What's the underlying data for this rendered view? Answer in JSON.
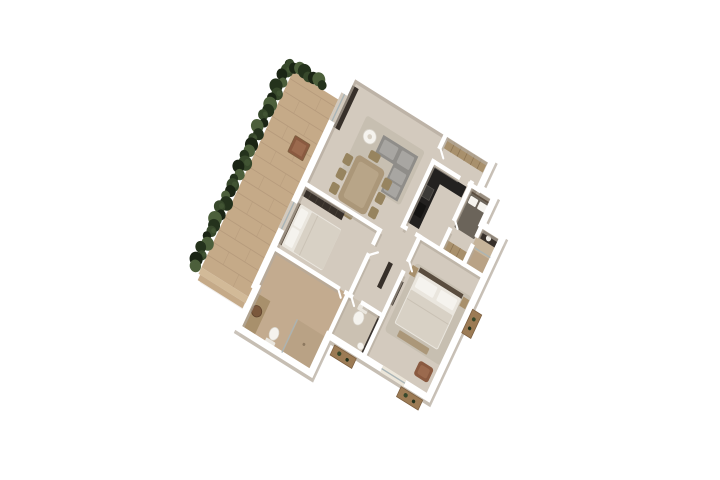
{
  "meta": {
    "type": "3d-floorplan-render",
    "view": "top-down isometric apartment render rotated about 32 degrees on white background"
  },
  "palette": {
    "background": "#ffffff",
    "shadow_soft": "#e3ded5",
    "deck_wood": "#c5aa88",
    "deck_line": "#b3987a",
    "deck_step": "#d2ba98",
    "hedge_deep": "#1a2414",
    "hedge_dark": "#24321c",
    "hedge_mid": "#37482b",
    "hedge_light": "#4c5f3b",
    "floor_main": "#d3cabe",
    "floor_bath": "#c3ab8f",
    "floor_wc": "#cbc1b2",
    "floor_ensuite": "#c6b49a",
    "wall": "#ffffff",
    "wall_shadow": "#b3a99c",
    "rug": "#c7bfb1",
    "sofa": "#8f8d89",
    "sofa_light": "#a8a6a2",
    "dark_furniture": "#37302a",
    "counter_black": "#232120",
    "wood_furniture": "#ab9779",
    "wood_light": "#b8a588",
    "chair": "#97845f",
    "wardrobe": "#a8906c",
    "wardrobe_line": "#8d7554",
    "bed_white": "#eae6de",
    "duvet": "#d8d1c5",
    "duvet_dark": "#6b645a",
    "pillow": "#f5f3ee",
    "headboard": "#5a4d3f",
    "leather_brown": "#8a5a40",
    "leather_light": "#9b6a4e",
    "basin_brown": "#7b583c",
    "planter_wood": "#9c7b55",
    "planter_edge": "#7c5f40",
    "glass": "#a9b4b6",
    "fixture_stroke": "#d8d3c9"
  },
  "scene": {
    "outdoor": {
      "deck_material": "wood plank terrace",
      "hedge_sides": [
        "west edge",
        "north corner"
      ],
      "deck_planter_count": 1,
      "exterior_planter_count": 3
    },
    "rooms": [
      {
        "name": "living-room",
        "furniture": [
          "sectional-sofa",
          "coffee-table",
          "media-console",
          "rug"
        ]
      },
      {
        "name": "entry-closet",
        "furniture": [
          "wardrobe"
        ]
      },
      {
        "name": "kitchen",
        "furniture": [
          "l-shaped-counter",
          "sink",
          "cooktop"
        ]
      },
      {
        "name": "dining-area",
        "furniture": [
          "dining-table",
          "dining-chairs"
        ],
        "chair_count": 8
      },
      {
        "name": "bedroom-2",
        "furniture": [
          "double-bed",
          "wardrobe"
        ]
      },
      {
        "name": "bedroom-3",
        "furniture": [
          "double-bed",
          "wardrobe"
        ]
      },
      {
        "name": "ensuite-bathroom",
        "furniture": [
          "vanity",
          "shower"
        ]
      },
      {
        "name": "master-bedroom",
        "furniture": [
          "double-bed",
          "nightstands",
          "bench",
          "armchair",
          "tv-console"
        ]
      },
      {
        "name": "wc",
        "furniture": [
          "toilet",
          "hand-basin"
        ]
      },
      {
        "name": "bathroom",
        "furniture": [
          "vanity",
          "vessel-basin",
          "toilet",
          "shower"
        ]
      },
      {
        "name": "hallway",
        "furniture": [
          "console-table"
        ]
      }
    ]
  }
}
